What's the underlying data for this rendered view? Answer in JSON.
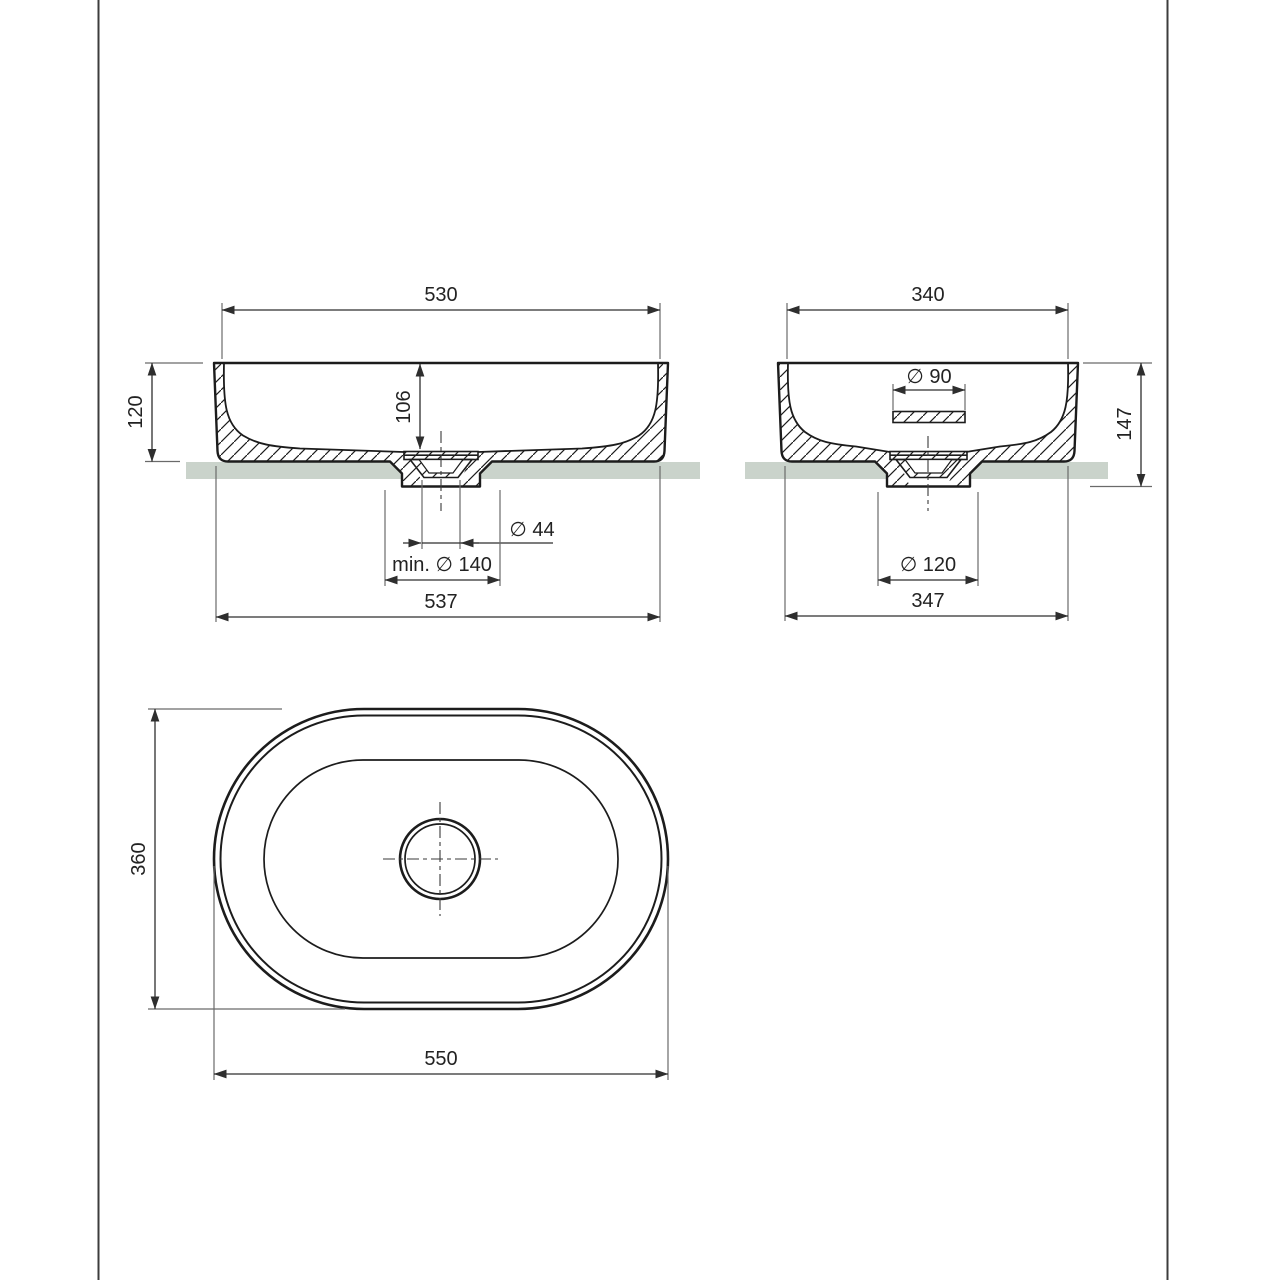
{
  "sheet": {
    "background": "#ffffff",
    "border_color": "#3c3c3c",
    "line_color": "#1c1c1c",
    "dimension_color": "#2e2e2e",
    "countertop_color": "#cad3cb"
  },
  "views": {
    "front": {
      "dims": {
        "width_top": "530",
        "height": "120",
        "bowl_depth": "106",
        "drain": "∅ 44",
        "min_recess": "min. ∅ 140",
        "width_bottom": "537"
      }
    },
    "side": {
      "dims": {
        "width_top": "340",
        "overflow": "∅ 90",
        "height_total": "147",
        "recess": "∅ 120",
        "width_bottom": "347"
      }
    },
    "top": {
      "dims": {
        "height": "360",
        "width": "550"
      }
    }
  }
}
